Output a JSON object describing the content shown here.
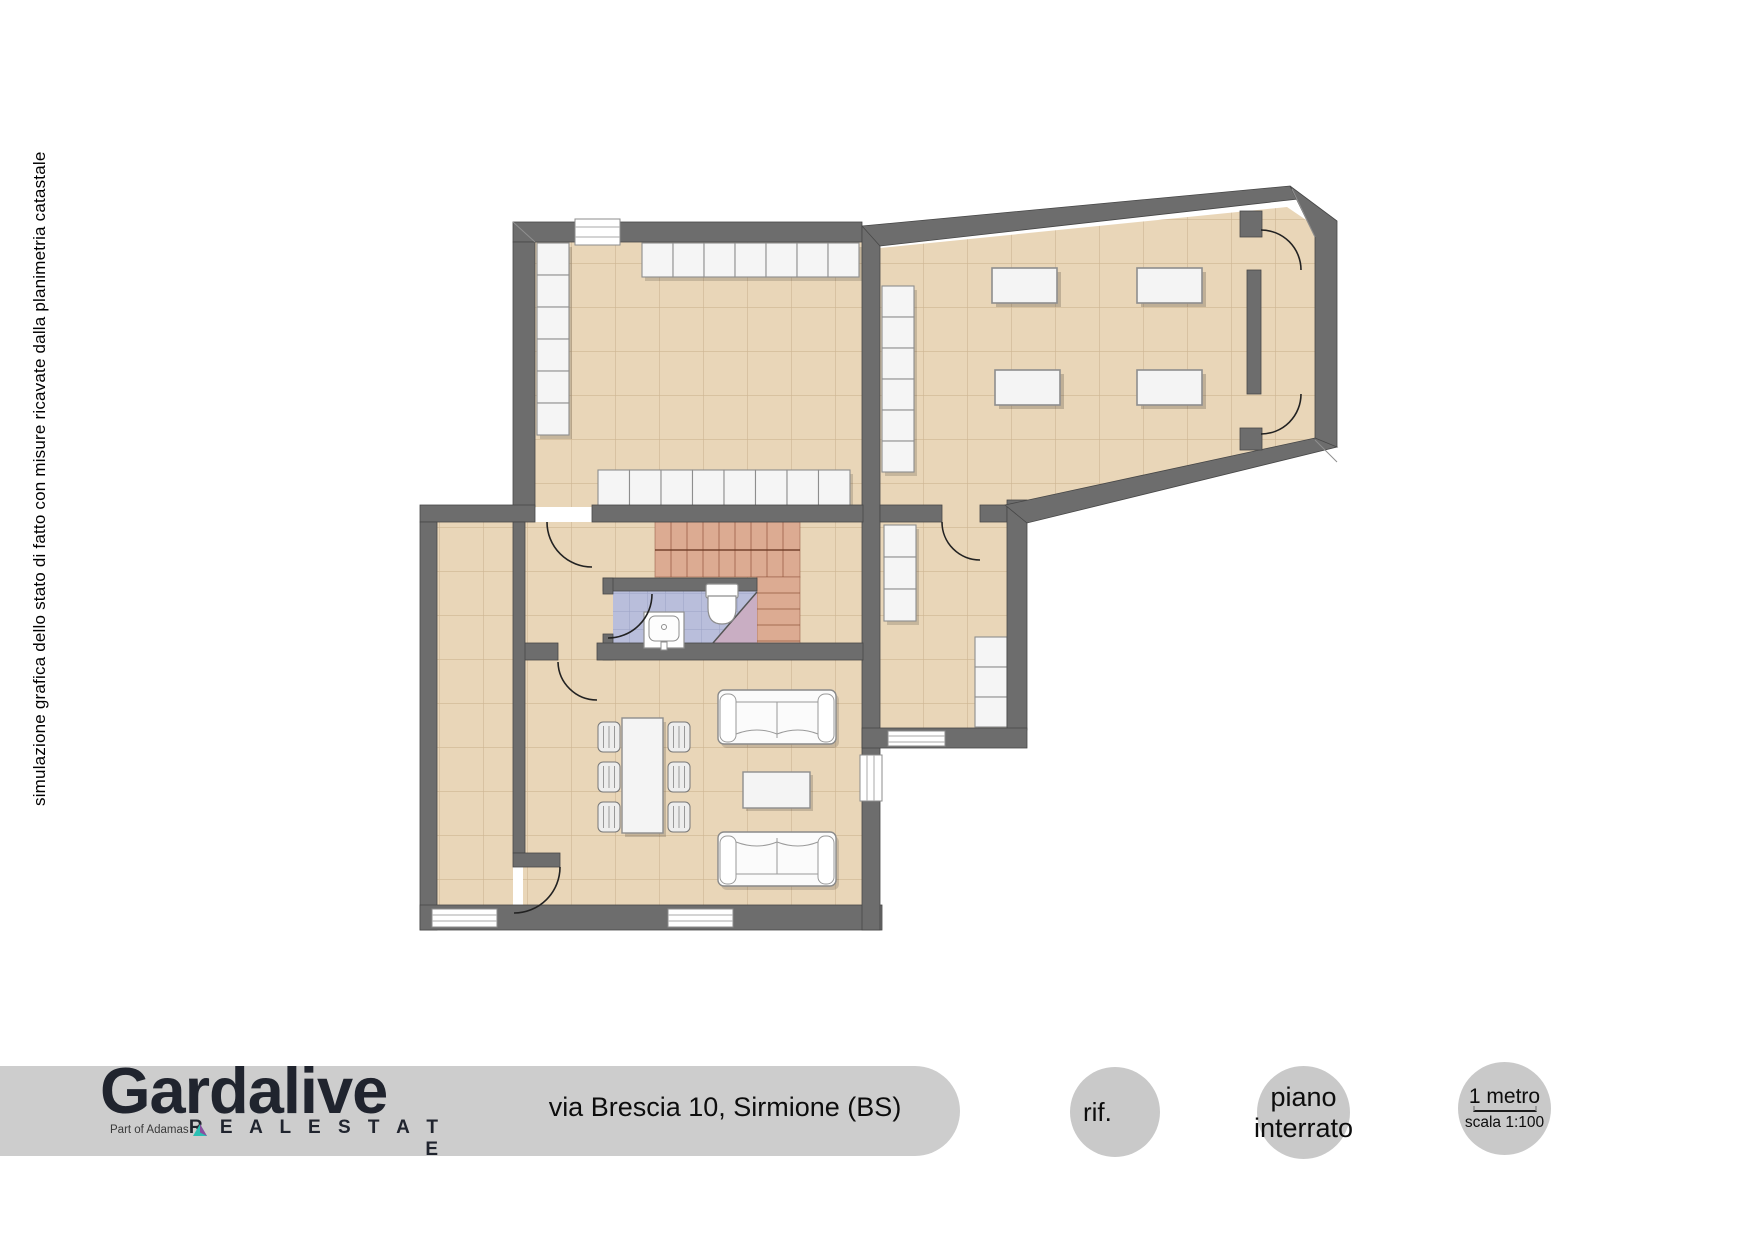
{
  "side_note": {
    "text": "simulazione grafica dello stato di fatto con misure ricavate dalla planimetria catastale"
  },
  "brand": {
    "name": "Gardalive",
    "tagline": "R E A L   E S T A T E",
    "partner": "Part of Adamas"
  },
  "address": {
    "line": "via Brescia 10, Sirmione (BS)"
  },
  "badges": {
    "reference": {
      "label": "rif."
    },
    "floor": {
      "line1": "piano",
      "line2": "interrato"
    },
    "scale": {
      "title": "1 metro",
      "caption": "scala 1:100"
    }
  },
  "colors": {
    "wall": "#6d6d6d",
    "floor_tile": "#e9d6b8",
    "stair_tile": "#dcab92",
    "bath_tile": "#b9bedb",
    "footer_band": "#cdcdcd",
    "badge_circle": "#c9c9c9",
    "brand_text": "#20242e"
  }
}
